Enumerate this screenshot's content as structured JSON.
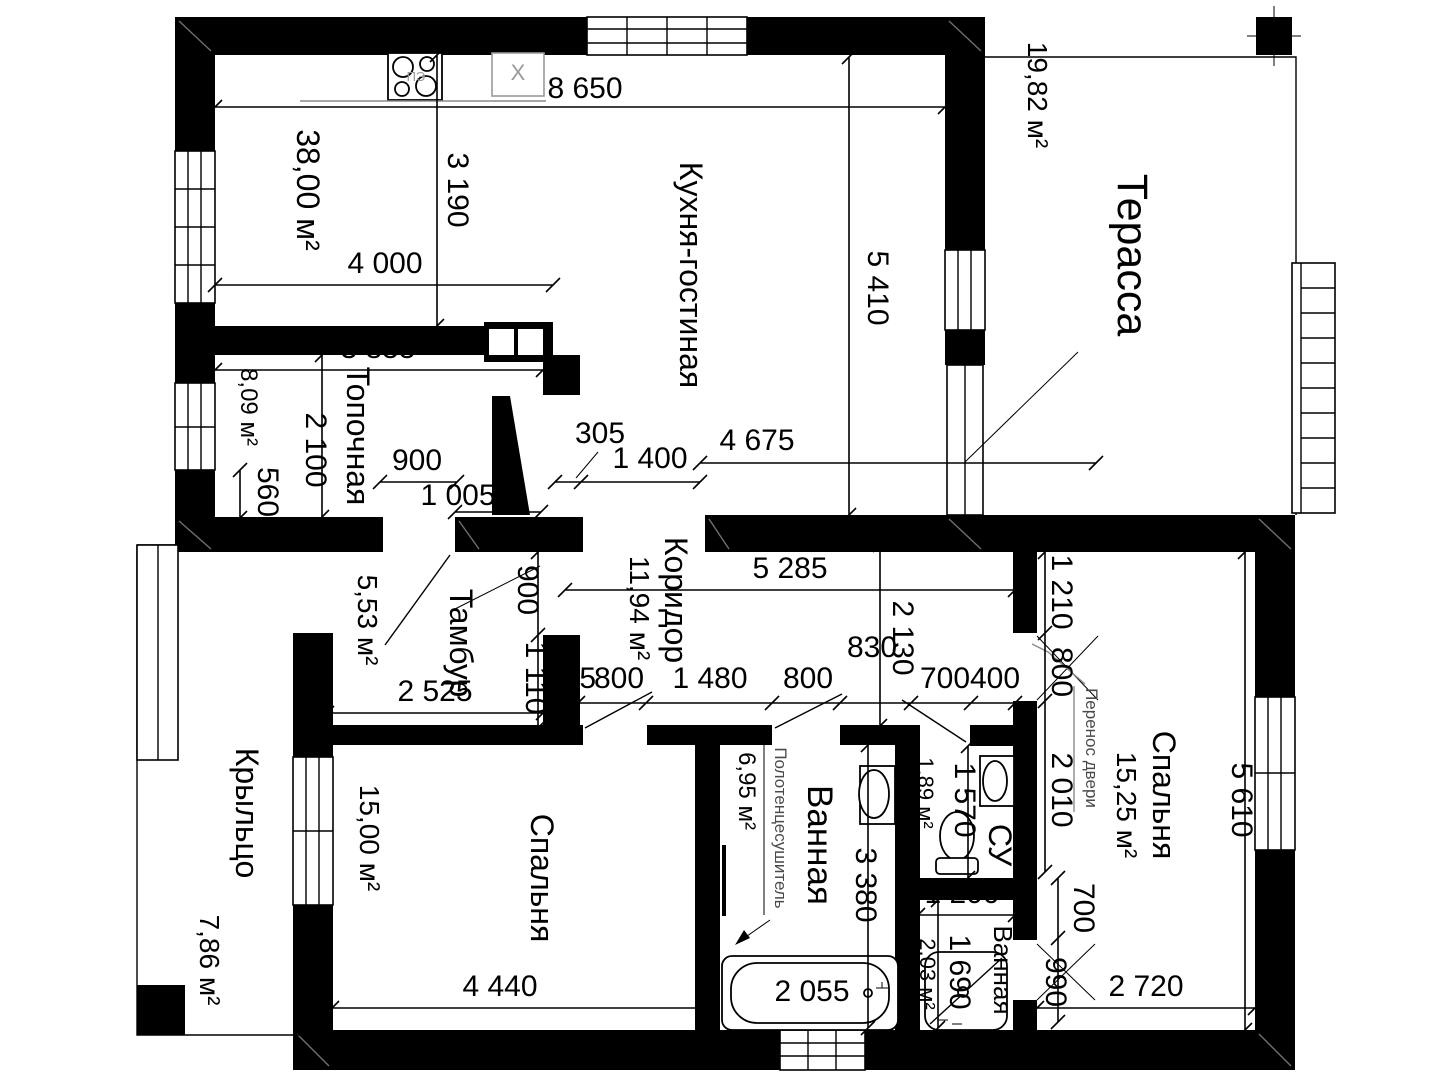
{
  "title": "Floor plan with dimensions",
  "rooms": {
    "kitchen_living": {
      "name": "Кухня-гостиная",
      "area": "38,00 м²"
    },
    "terrace": {
      "name": "Терасса",
      "area": "19,82 м²"
    },
    "boiler": {
      "name": "Топочная",
      "area": "8,09 м²"
    },
    "vestibule": {
      "name": "Тамбур",
      "area": "5,53 м²"
    },
    "corridor": {
      "name": "Коридор",
      "area": "11,94 м²"
    },
    "bedroom_left": {
      "name": "Спальня",
      "area": "15,00 м²"
    },
    "bedroom_right": {
      "name": "Спальня",
      "area": "15,25 м²"
    },
    "bathroom": {
      "name": "Ванная",
      "area": "6,95 м²"
    },
    "wc": {
      "name": "СУ",
      "area": "1,89 м²"
    },
    "shower_room": {
      "name": "Ванная",
      "area": "2,03 м²"
    },
    "porch": {
      "name": "Крыльцо",
      "area": "7,86 м²"
    }
  },
  "annotations": {
    "door_relocation": "Перенос двери",
    "towel_dryer": "Полотенцесушитель"
  },
  "fixtures": {
    "stove_label": "ПЭ",
    "appliance_label": "X"
  },
  "dimensions": {
    "house_top_width": "8 650",
    "kitchen_left_depth": "3 190",
    "kitchen_left_width": "4 000",
    "kitchen_right_depth": "5 410",
    "boiler_width": "3 855",
    "boiler_depth": "2 100",
    "boiler_wall": "560",
    "boiler_door": "900",
    "boiler_door_offset": "1 005",
    "wall_thickness": "305",
    "kitchen_opening": "1 400",
    "living_width": "4 675",
    "corridor_length": "5 285",
    "corridor_width": "2 130",
    "corridor_offset": "830",
    "vestibule_door": "900",
    "vestibule_wall": "1 110",
    "vestibule_width": "2 525",
    "seg_275": "275",
    "bedroom_left_door": "800",
    "seg_1480": "1 480",
    "bathroom_door": "800",
    "wc_door": "700",
    "seg_400": "400",
    "bedroom_right_wall_top": "1 210",
    "bedroom_right_door": "800",
    "bedroom_right_wall_bottom": "2 010",
    "bedroom_right_depth": "5 610",
    "shower_door_top": "700",
    "shower_door": "990",
    "bedroom_right_width": "2 720",
    "wc_depth": "1 570",
    "bathroom_depth": "3 380",
    "bathtub_length": "2 055",
    "shower_width": "1 200",
    "shower_depth": "1 690",
    "bedroom_left_width": "4 440"
  }
}
